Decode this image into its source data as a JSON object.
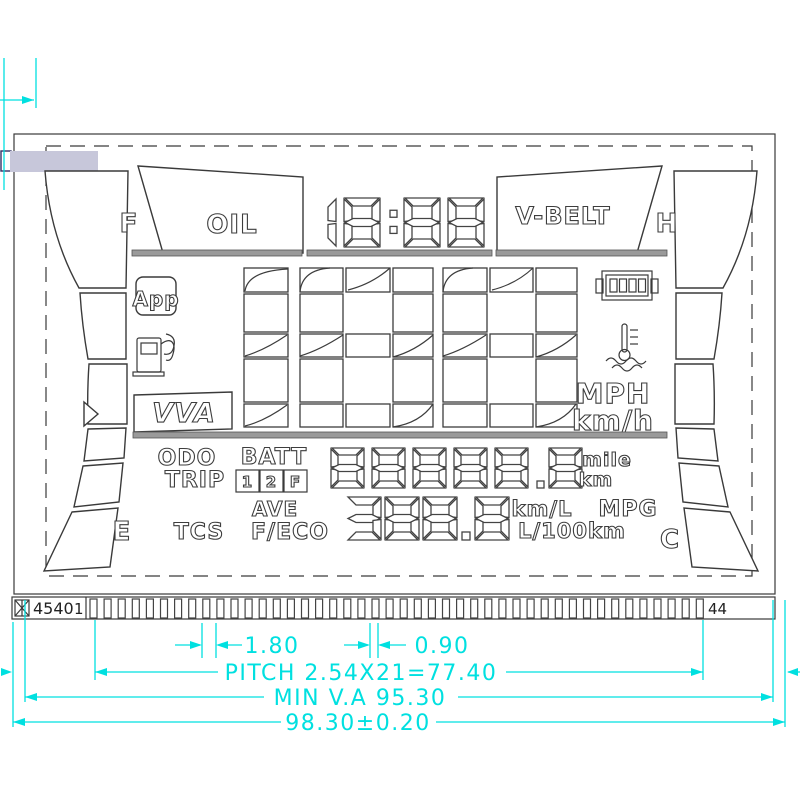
{
  "meta": {
    "drawing_type": "LCD segment panel technical drawing",
    "accent_cyan": "#00e0e0",
    "glass_tab_fill": "#c7c7da",
    "line_color": "#3a3a3a"
  },
  "top": {
    "fuel_full_label": "F",
    "oil_label": "OIL",
    "clock_value": "18:88",
    "vbelt_label": "V-BELT",
    "temp_hot_label": "H"
  },
  "left_panel": {
    "app_label": "App",
    "vva_label": "VVA",
    "fuel_empty_label": "E",
    "icons": [
      "app-icon",
      "fuel-pump-icon",
      "gauge-pointer-icon"
    ]
  },
  "right_panel": {
    "temp_cold_label": "C",
    "unit_mph": "MPH",
    "unit_kmh": "km/h",
    "icons": [
      "battery-icon",
      "coolant-temp-icon"
    ]
  },
  "speed": {
    "value": "188"
  },
  "odo_row": {
    "odo_label": "ODO",
    "trip_label": "TRIP",
    "batt_label": "BATT",
    "batt_mode": [
      "1",
      "2",
      "F"
    ],
    "value": "88888.8",
    "unit_mile": "mile",
    "unit_km": "km"
  },
  "eco_row": {
    "ave_label": "AVE",
    "tcs_label": "TCS",
    "feco_label": "F/ECO",
    "value": "388.8",
    "unit_kml": "km/L",
    "unit_mpg": "MPG",
    "unit_l100": "L/100km"
  },
  "connector": {
    "part_no": "4540",
    "first_pin_label": "1",
    "last_pin_label": "44",
    "pin_count": 44
  },
  "dimensions": {
    "pin_pitch_small": "1.80",
    "pin_width": "0.90",
    "pitch_total": "PITCH  2.54X21=77.40",
    "min_va": "MIN  V.A  95.30",
    "overall": "98.30±0.20"
  }
}
